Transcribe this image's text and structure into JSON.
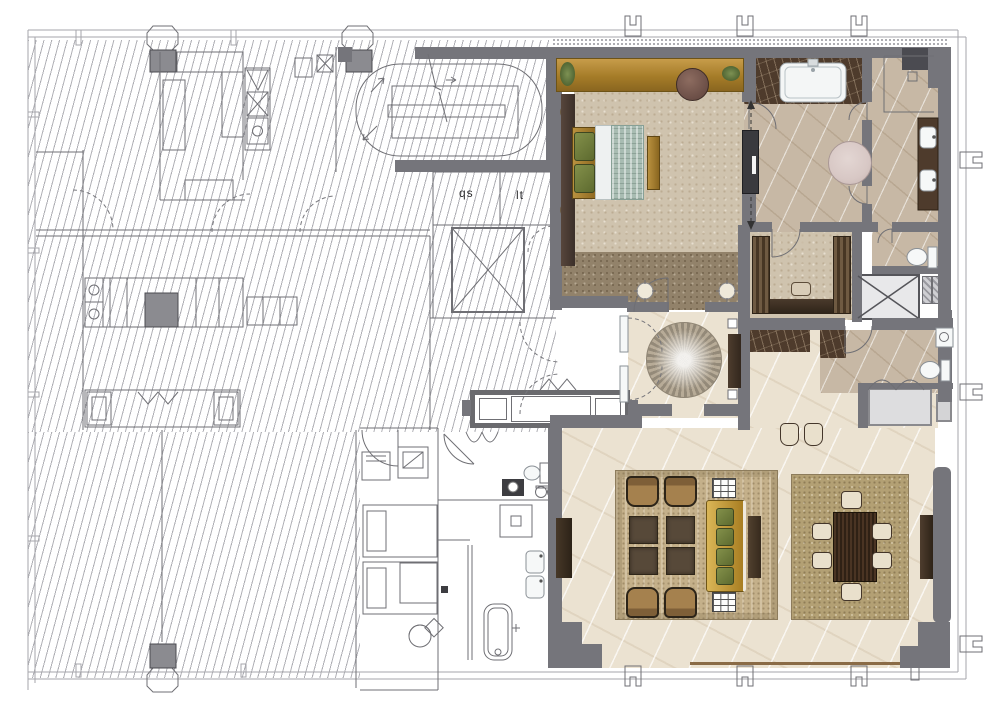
{
  "labels": {
    "room_label_left": "qs",
    "room_label_right": "lt"
  },
  "palette": {
    "wall": "#75757b",
    "walldark": "#4b4b51",
    "line": "#6f6f74",
    "border": "#a6a6ab",
    "gold": "#b08a3c",
    "carpet": "#cfc3ae",
    "corridor": "#92826a",
    "cream": "#ebe2d1",
    "tan": "#c7b8a5",
    "emperador": "#4e3b2c",
    "teal": "#a8bcb2",
    "green": "#6d7a3e",
    "wood": "#3c2f23",
    "pink": "#d8c8c5",
    "sofa": "#c79f3c",
    "chair": "#a07c4a",
    "ottoman": "#574939",
    "rug": "#c4b08a",
    "rugdining": "#b3a074",
    "lift": "#e8e8ea",
    "tub": "#f4f6f6",
    "floorline": "#8a6b46"
  }
}
